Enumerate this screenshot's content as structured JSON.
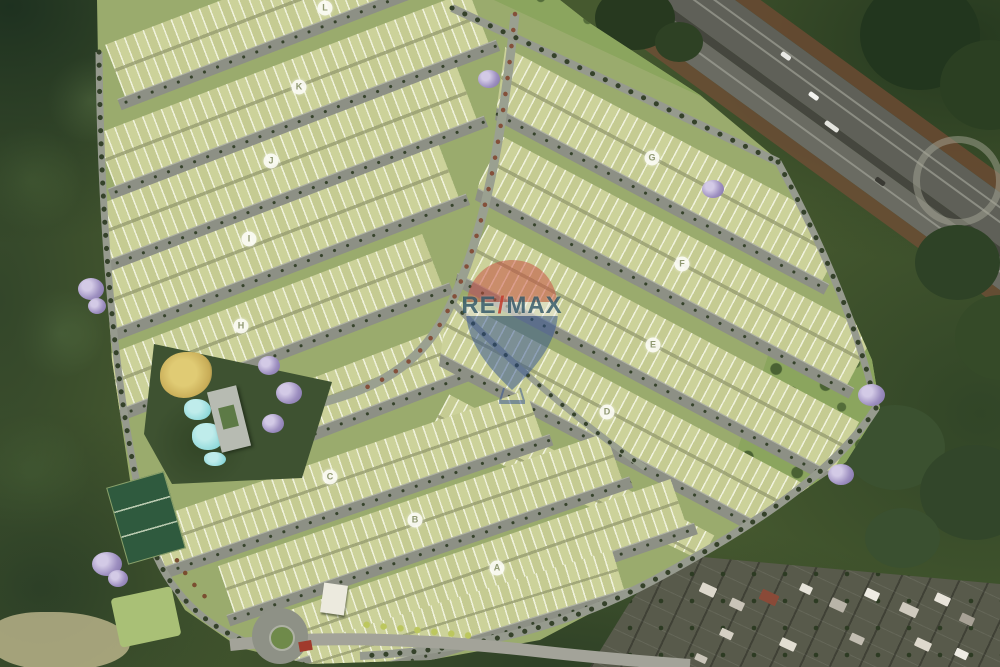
{
  "watermark": {
    "brand_left": "RE",
    "brand_slash": "/",
    "brand_right": "MAX",
    "balloon_colors": {
      "top": "#c94a3e",
      "band": "#f2efe8",
      "bottom": "#2e4f92"
    }
  },
  "blocks": [
    {
      "letter": "L",
      "x": 325,
      "y": 8
    },
    {
      "letter": "K",
      "x": 299,
      "y": 87
    },
    {
      "letter": "J",
      "x": 271,
      "y": 161
    },
    {
      "letter": "I",
      "x": 249,
      "y": 239
    },
    {
      "letter": "H",
      "x": 241,
      "y": 326
    },
    {
      "letter": "G",
      "x": 652,
      "y": 158
    },
    {
      "letter": "F",
      "x": 682,
      "y": 264
    },
    {
      "letter": "E",
      "x": 653,
      "y": 345
    },
    {
      "letter": "D",
      "x": 607,
      "y": 412
    },
    {
      "letter": "C",
      "x": 330,
      "y": 477
    },
    {
      "letter": "B",
      "x": 415,
      "y": 520
    },
    {
      "letter": "A",
      "x": 497,
      "y": 568
    }
  ],
  "colors": {
    "lot_green": "#ccd29a",
    "road_gray": "#8d9085",
    "grass": "#9aab6d",
    "forest_dark": "#3a4d2c",
    "pool_cyan": "#8ed8da",
    "flowering_purple": "#9d8fc0",
    "playground_yellow": "#e0cb74",
    "highway_asphalt": "#5f6058",
    "embankment_brown": "#6b4a33"
  }
}
